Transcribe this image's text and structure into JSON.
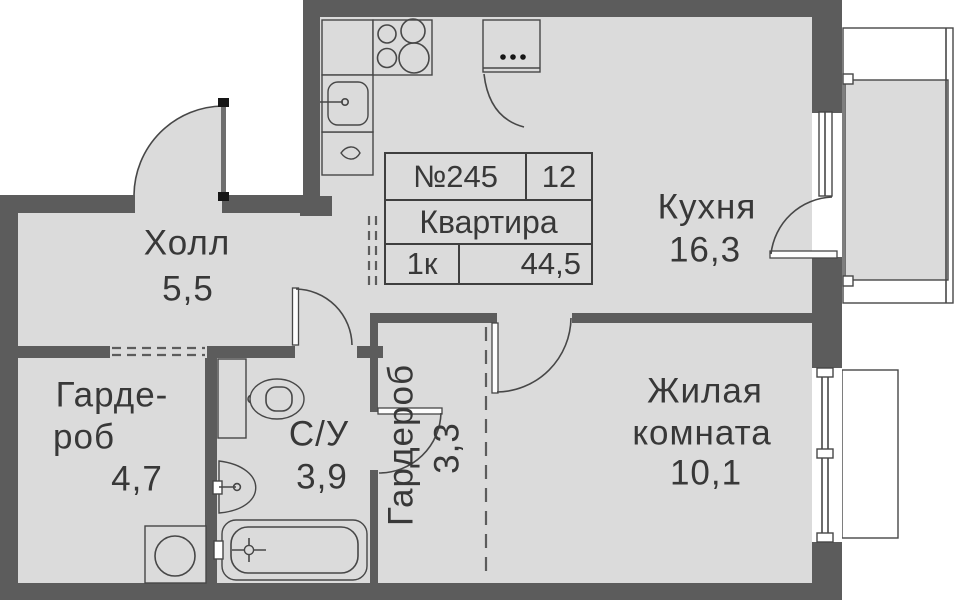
{
  "title_block": {
    "apartment_number": "№245",
    "floor": "12",
    "object_label": "Квартира",
    "rooms_label": "1к",
    "total_area": "44,5"
  },
  "rooms": {
    "hall": {
      "name": "Холл",
      "area": "5,5"
    },
    "kitchen": {
      "name": "Кухня",
      "area": "16,3"
    },
    "wardrobe1": {
      "name_line1": "Гарде-",
      "name_line2": "роб",
      "area": "4,7"
    },
    "bathroom": {
      "name": "С/У",
      "area": "3,9"
    },
    "wardrobe2": {
      "name": "Гардероб",
      "area": "3,3"
    },
    "living_room": {
      "name_line1": "Жилая",
      "name_line2": "комната",
      "area": "10,1"
    }
  },
  "icons": [
    "stove-icon",
    "kitchen-sink-icon",
    "kitchen-cabinet-icon",
    "fridge-icon",
    "toilet-icon",
    "washbasin-icon",
    "bathtub-icon",
    "washing-machine-icon",
    "door-swing-icon",
    "window-icon",
    "balcony-icon"
  ],
  "colors": {
    "floor": "#dbdbdb",
    "wall": "#5c5c5c",
    "line": "#474747",
    "text": "#383838",
    "outside": "#ffffff"
  }
}
